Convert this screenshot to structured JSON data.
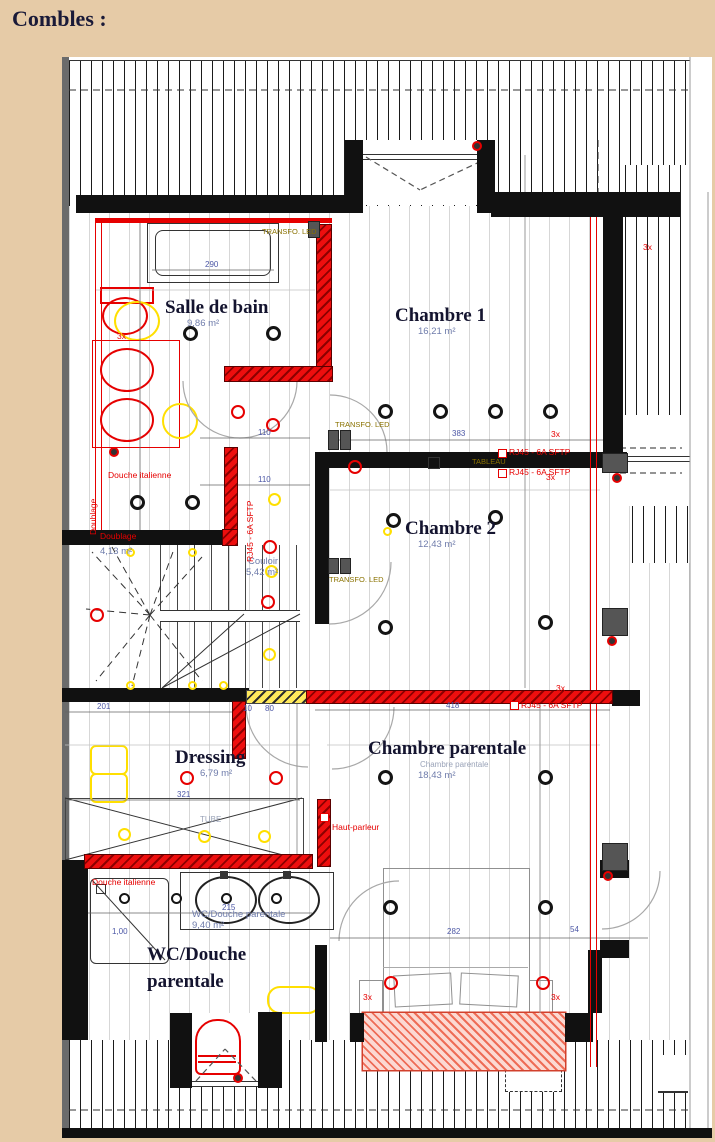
{
  "page": {
    "title": "Combles :"
  },
  "rooms": {
    "salle_de_bain": {
      "name": "Salle de bain",
      "area": "9,86 m²"
    },
    "chambre1": {
      "name": "Chambre 1",
      "area": "16,21 m²"
    },
    "chambre2": {
      "name": "Chambre 2",
      "area": "12,43 m²"
    },
    "couloir": {
      "name": "Couloir",
      "area": "5,42 m²"
    },
    "palier": {
      "area": "4,13 m²"
    },
    "dressing": {
      "name": "Dressing",
      "area": "6,79 m²"
    },
    "chambre_parentale": {
      "name": "Chambre parentale",
      "area": "18,43 m²"
    },
    "wc_douche": {
      "name": "WC/Douche parentale",
      "area": "9,40 m²",
      "big1": "WC/Douche",
      "big2": "parentale"
    }
  },
  "labels": {
    "transfo_led": "TRANSFO. LED",
    "tableau": "TABLEAU",
    "rj45": "RJ45 - 6A SFTP",
    "douche_italienne": "Douche italienne",
    "doublage": "Doublage",
    "haut_parleur": "Haut-parleur",
    "x3": "3x",
    "tube": "TUBE"
  },
  "dimensions": {
    "tub_width": "290",
    "couloir_a": "110",
    "couloir_b": "110",
    "ch1_width": "383",
    "parentale_top": "418",
    "dressing_width": "321",
    "wc_width": "215",
    "wc_left": "1,00",
    "bed_width": "282",
    "bed_right": "54",
    "dressing_top": "201",
    "d80": "80",
    "d10": "10"
  },
  "colors": {
    "wall": "#111111",
    "new_wall": "#e60000",
    "accent_yellow": "#ffdf00",
    "page_bg": "#e6cba7"
  }
}
